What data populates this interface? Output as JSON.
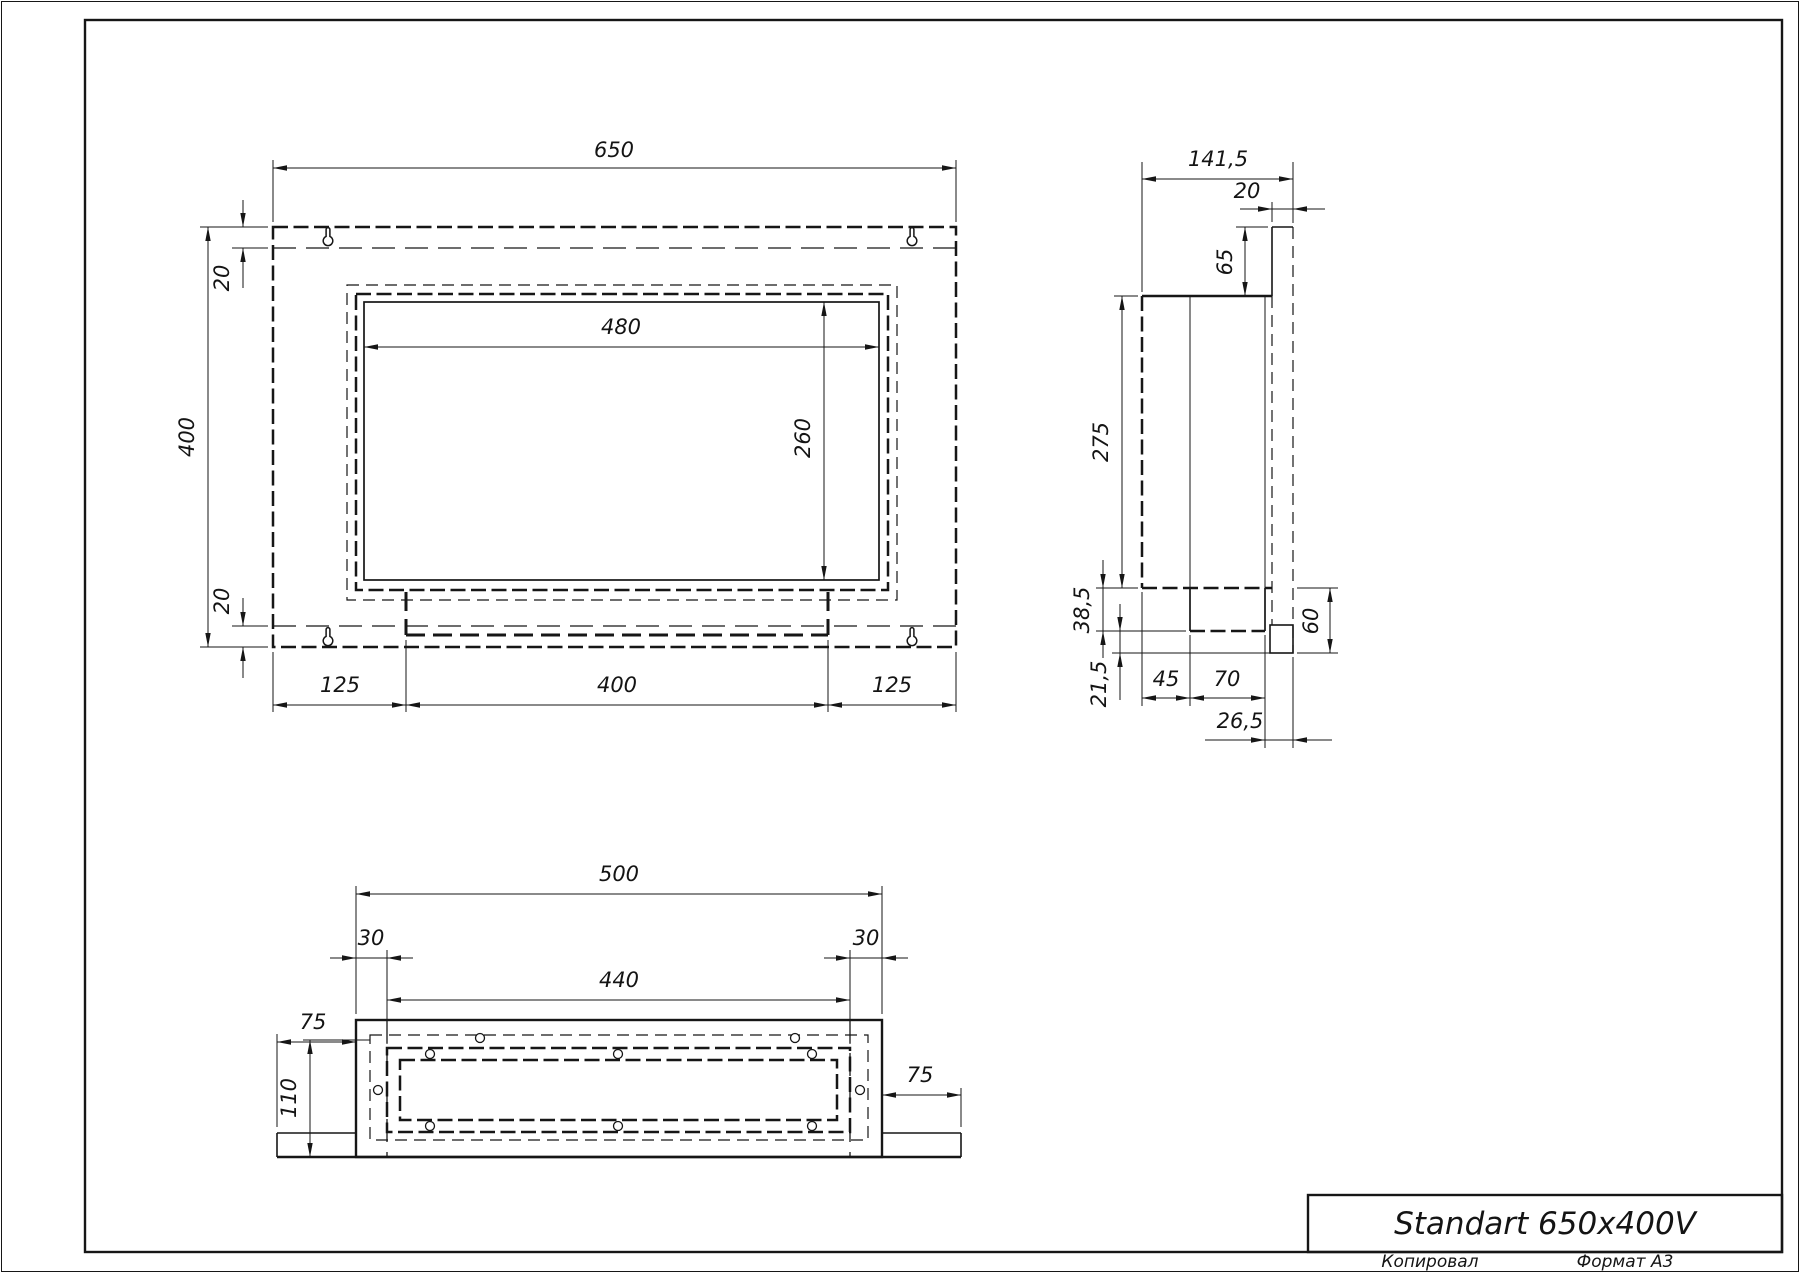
{
  "drawing": {
    "title_block": {
      "title": "Standart 650x400V"
    },
    "footer": {
      "copied": "Копировал",
      "format": "Формат A3"
    },
    "front_view": {
      "overall_width": "650",
      "overall_height": "400",
      "top_inset": "20",
      "bottom_inset": "20",
      "opening_width": "480",
      "opening_height": "260",
      "left_margin": "125",
      "burner_width": "400",
      "right_margin": "125"
    },
    "side_view": {
      "overall_depth": "141,5",
      "flange_depth": "20",
      "top_drop": "65",
      "body_height": "275",
      "tray_drop": "38,5",
      "tray_clearance": "21,5",
      "burner_setback": "45",
      "burner_depth": "70",
      "spout_offset": "26,5",
      "skirt_height": "60"
    },
    "bottom_view": {
      "body_width": "500",
      "edge_inset_left": "30",
      "edge_inset_right": "30",
      "bolt_span": "440",
      "flange_left": "75",
      "flange_right": "75",
      "body_depth": "110"
    }
  }
}
